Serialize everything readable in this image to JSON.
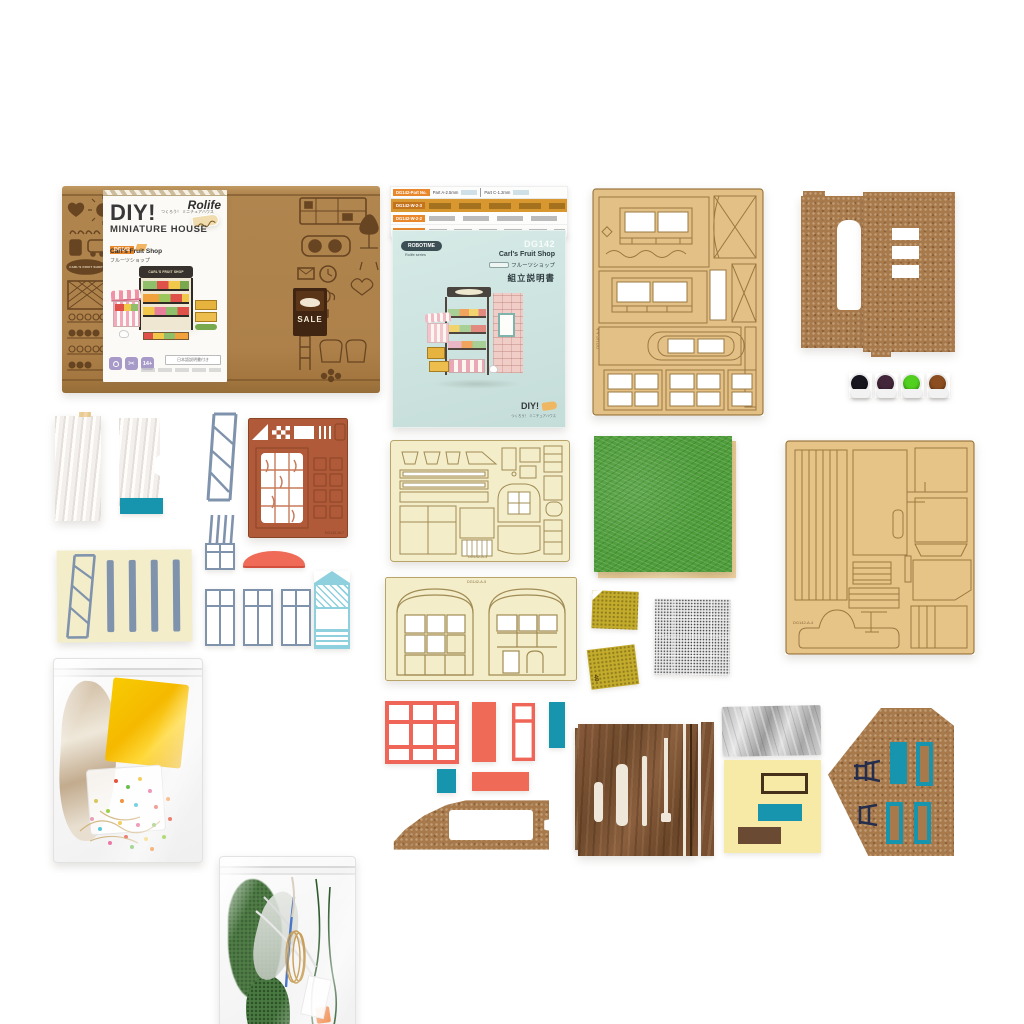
{
  "box": {
    "brand": "Rolife",
    "title": "DIY!",
    "title_jp": "つくろう！ ミニチュアハウス",
    "subtitle": "MINIATURE HOUSE",
    "model_badge": "DG142",
    "product_name": "Carl's Fruit Shop",
    "product_name_jp": "フルーツショップ",
    "shop_sign": "CARL'S FRUIT SHOP",
    "sale_sign": "SALE",
    "age_badge": "14+",
    "jp_note": "日本語説明書付き",
    "icons": [
      "led-light",
      "scissors",
      "age-14"
    ]
  },
  "parts_list": {
    "header_badge": "DG142-Part No.",
    "col_a": "Part A-2.5mm",
    "col_c": "Part C-1.2mm",
    "rows": [
      "DG142-W-2-3",
      "DG142-W-2-2",
      "DG142-W-3-1"
    ]
  },
  "manual": {
    "brand": "ROBOTIME",
    "series": "Rolife series",
    "model": "DG142",
    "title": "Carl's Fruit Shop",
    "title_jp": "フルーツショップ",
    "doc_title": "組立説明書",
    "diy": "DIY!",
    "diy_sub": "つくろう！ ミニチュアハウス"
  },
  "sheet_marks": {
    "plywood_top": "DG142-A-A",
    "cream_mid": "DG142-A-3",
    "plywood_large": "DG142-A-4",
    "brown_detail": "DG142-W-7",
    "arched": "DG142-A-5",
    "sandpaper_grit": "40"
  },
  "paint_colors": [
    "#17161f",
    "#44263a",
    "#52d01f",
    "#8c4e21"
  ],
  "colors": {
    "kraft": "#b0854e",
    "print_brown": "#5f3d1d",
    "accent_orange": "#e8872b",
    "plywood": "#e3c186",
    "cream_sheet": "#f4edca",
    "cork": "#a87a4b",
    "teal": "#1795ae",
    "coral": "#ef6a57",
    "steel_blue": "#8093ad",
    "felt_green": "#4f9e3b",
    "walnut": "#7b5233",
    "mint_cover": "#cfe5e1",
    "lavender_badge": "#a79ac9"
  }
}
